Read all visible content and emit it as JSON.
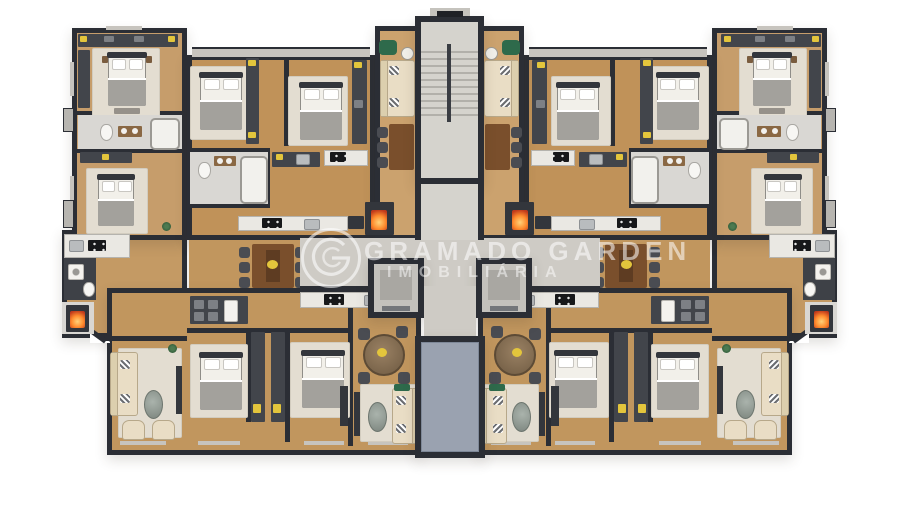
{
  "watermark": {
    "logo": "gramado-garden-circle-g-logo",
    "line1": "GRAMADO GARDEN",
    "line2": "IMOBILIÁRIA"
  },
  "colors": {
    "wall": "#2b2e35",
    "wood_a": "#c69d6b",
    "wood_b": "#c09259",
    "wood_c": "#cba26e",
    "wood_d": "#c49a64",
    "wood_e": "#c1965e",
    "rug": "#e3ddd1",
    "tile": "#d9d7d3",
    "tile_dark": "#3e4147",
    "corridor": "#cecbc5",
    "stair": "#d5d3cd",
    "tread": "#b2b0aa",
    "core_blue": "#9aa2b0",
    "counter": "#eae8e3",
    "appliance": "#33363c",
    "cabinet": "#42454b",
    "sofa": "#e9ddc5",
    "chair": "#4a4c52",
    "table_wood": "#7a4f2c",
    "bed_blanket": "#a3a19c",
    "headboard": "#33363c",
    "fire_hot": "#ff8c2e",
    "fire_deep": "#c0391b",
    "accent_yellow": "#e3c53c",
    "accent_green": "#2e6a4b",
    "watermark": "rgba(255,255,255,0.55)"
  }
}
